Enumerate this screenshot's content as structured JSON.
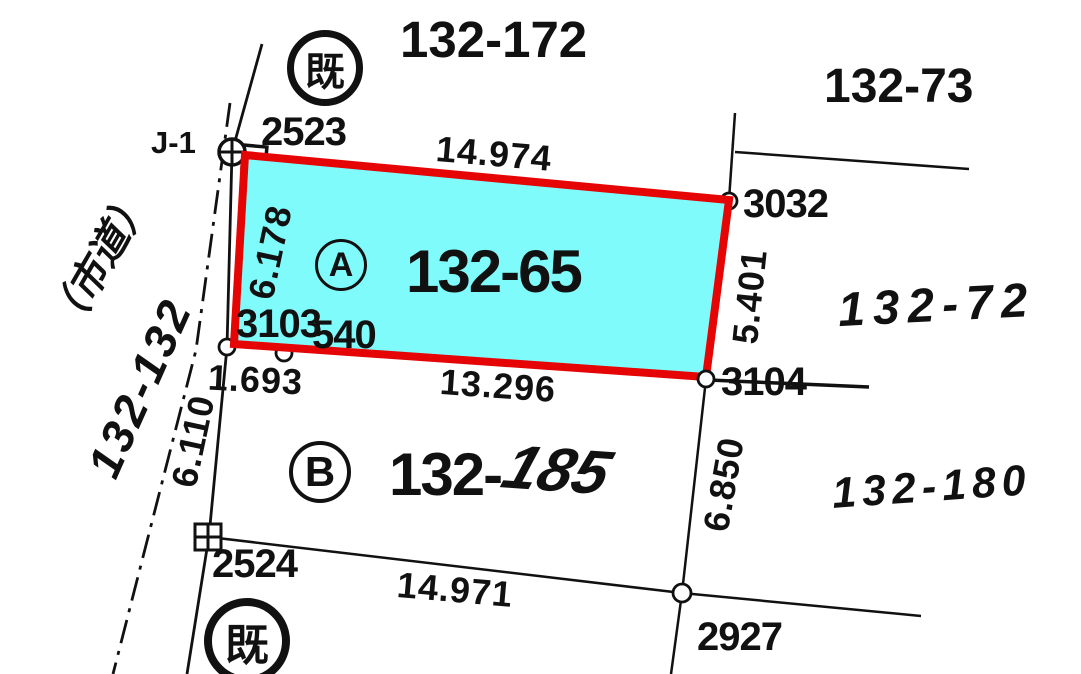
{
  "labels": {
    "stamp_top": "既",
    "stamp_bottom": "既",
    "title_north": "132-172",
    "title_northeast": "132-73",
    "j1": "J-1",
    "pt_2523": "2523",
    "pt_3032": "3032",
    "pt_3103": "3103",
    "pt_540": "540",
    "pt_3104": "3104",
    "pt_2524": "2524",
    "pt_2927": "2927",
    "len_top": "14.974",
    "len_left": "6.178",
    "len_right": "5.401",
    "len_bottom": "13.296",
    "len_1693": "1.693",
    "len_road": "6.110",
    "len_b_right": "6.850",
    "len_b_bottom": "14.971",
    "parcel_a_marker": "A",
    "parcel_a_number": "132-65",
    "parcel_b_marker": "B",
    "parcel_b_number_printed": "132-",
    "parcel_b_number_handwritten": "185",
    "parcel_east": "132-72",
    "parcel_southeast": "132-180",
    "road_name": "（市道）",
    "road_number": "132-132"
  },
  "colors": {
    "highlight_fill": "#80fbfc",
    "highlight_stroke": "#e60505",
    "line": "#111111"
  }
}
